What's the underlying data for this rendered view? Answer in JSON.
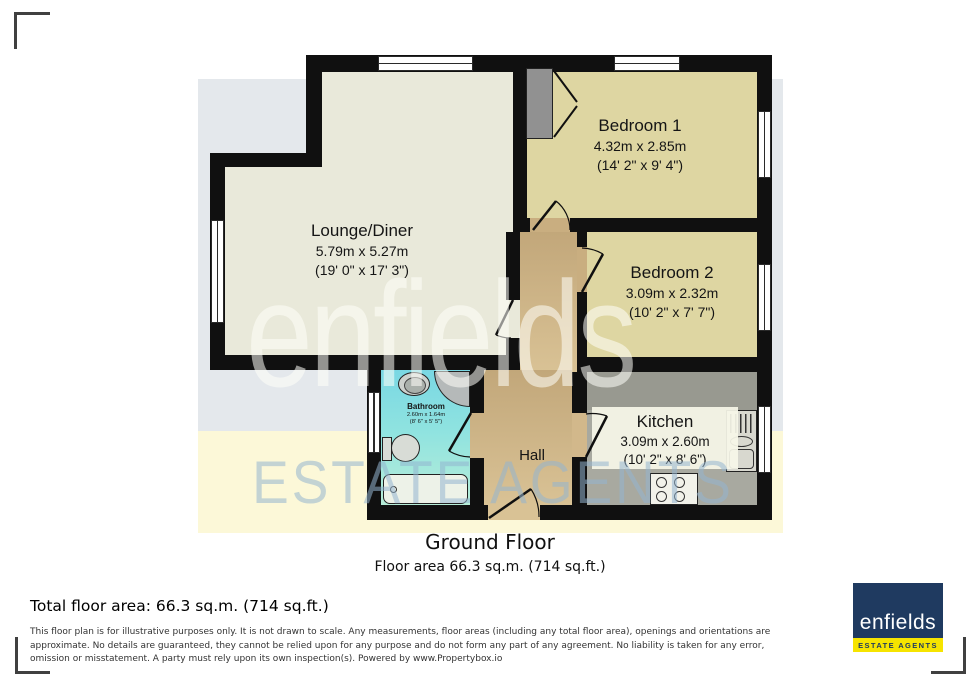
{
  "watermark": {
    "line1": "enfields",
    "line2": "ESTATE AGENTS"
  },
  "plan": {
    "rooms": {
      "lounge": {
        "name": "Lounge/Diner",
        "metric": "5.79m x 5.27m",
        "imperial": "(19' 0\" x 17' 3\")"
      },
      "bedroom1": {
        "name": "Bedroom 1",
        "metric": "4.32m x 2.85m",
        "imperial": "(14' 2\" x 9' 4\")"
      },
      "bedroom2": {
        "name": "Bedroom 2",
        "metric": "3.09m x 2.32m",
        "imperial": "(10' 2\" x 7' 7\")"
      },
      "kitchen": {
        "name": "Kitchen",
        "metric": "3.09m x 2.60m",
        "imperial": "(10' 2\" x 8' 6\")"
      },
      "bathroom": {
        "name": "Bathroom",
        "metric": "2.60m x 1.64m",
        "imperial": "(8' 6\" x 5' 5\")"
      },
      "hall": {
        "name": "Hall"
      }
    }
  },
  "caption": {
    "title": "Ground Floor",
    "subtitle": "Floor area 66.3 sq.m. (714 sq.ft.)"
  },
  "footer": {
    "total_area": "Total floor area: 66.3 sq.m. (714 sq.ft.)",
    "disclaimer": "This floor plan is for illustrative purposes only. It is not drawn to scale. Any measurements, floor areas (including any total floor area), openings and orientations are approximate. No details are guaranteed, they cannot be relied upon for any purpose and do not form any part of any agreement. No liability is taken for any error, omission or misstatement. A party must rely upon its own inspection(s). Powered by www.Propertybox.io",
    "logo": {
      "name": "enfields",
      "tagline": "ESTATE AGENTS"
    }
  },
  "colors": {
    "wall": "#101010",
    "lounge_floor": "#e9e9da",
    "bedroom_floor": "#ded6a2",
    "hall_floor": "#cdb285",
    "bathroom_floor": "#84dce2",
    "kitchen_floor": "#a8a9a0",
    "band_gray": "#e4e8ec",
    "band_yellow": "#fcf8d8",
    "logo_navy": "#1f3a60",
    "logo_yellow": "#f6e400"
  }
}
